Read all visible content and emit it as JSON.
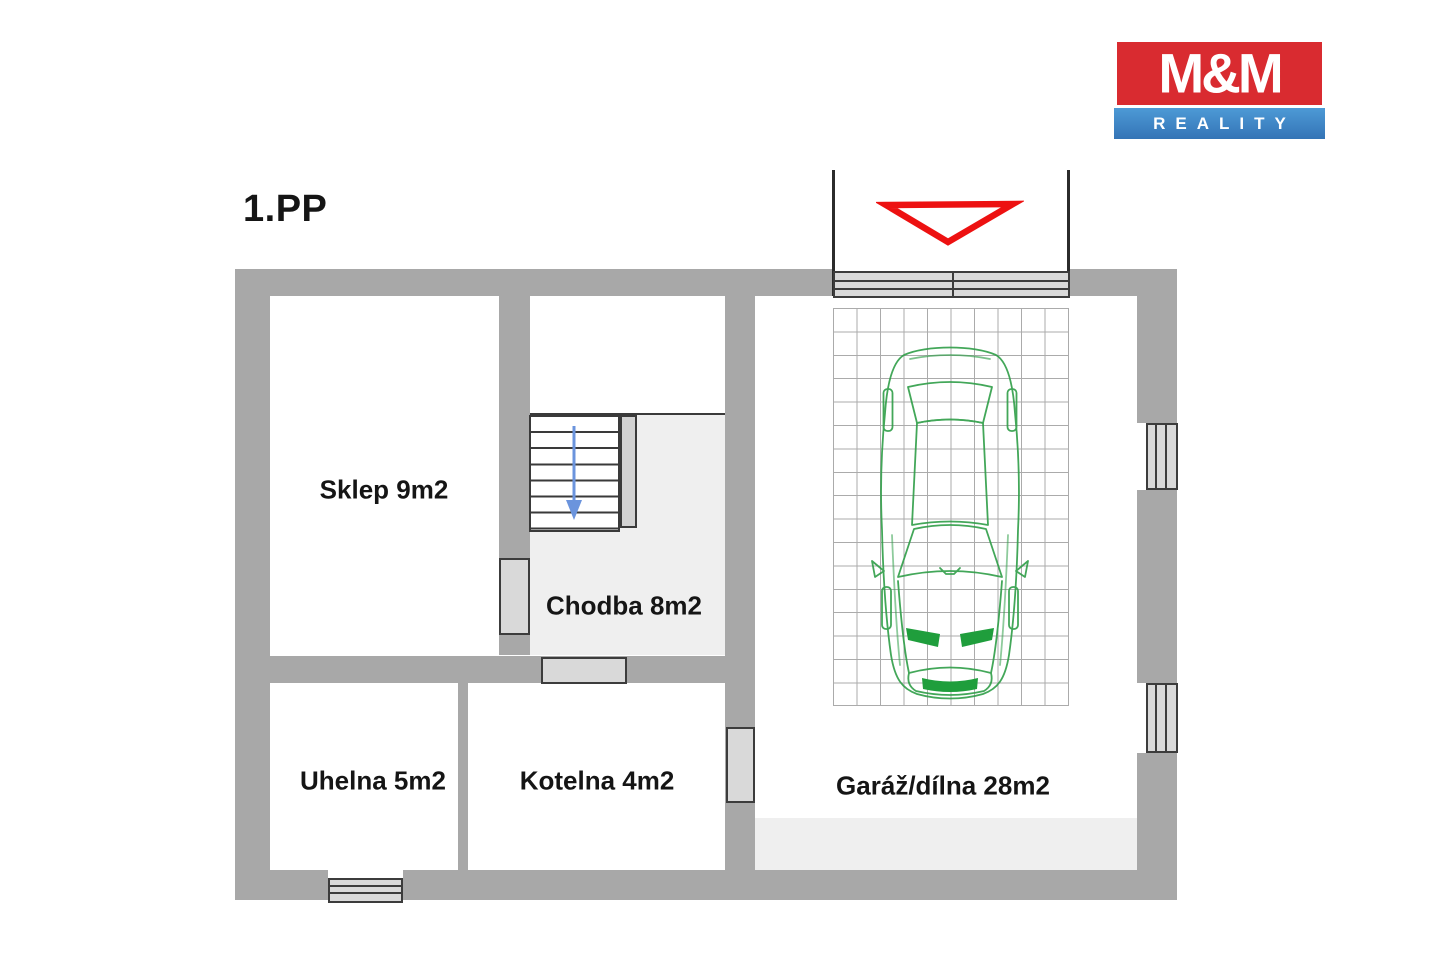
{
  "title": "1.PP",
  "logo": {
    "brand": "M&M",
    "tagline": "REALITY",
    "brand_bg": "#d92b30",
    "tagline_bg": "#3f8ccb"
  },
  "rooms": [
    {
      "name": "sklep",
      "label": "Sklep 9m2"
    },
    {
      "name": "chodba",
      "label": "Chodba 8m2"
    },
    {
      "name": "uhelna",
      "label": "Uhelna 5m2"
    },
    {
      "name": "kotelna",
      "label": "Kotelna 4m2"
    },
    {
      "name": "garaz-dilna",
      "label": "Garáž/dílna 28m2"
    }
  ],
  "symbols": {
    "wall_color": "#a8a8a8",
    "floor_color": "#efefef",
    "fixture_fill": "#d9d9d9",
    "fixture_border": "#3c3c3c",
    "stairs_arrow_color": "#6b94dd",
    "entry_marker_color": "#ed1111",
    "car_color": "#2f9e48",
    "grid_color": "#ababab"
  }
}
